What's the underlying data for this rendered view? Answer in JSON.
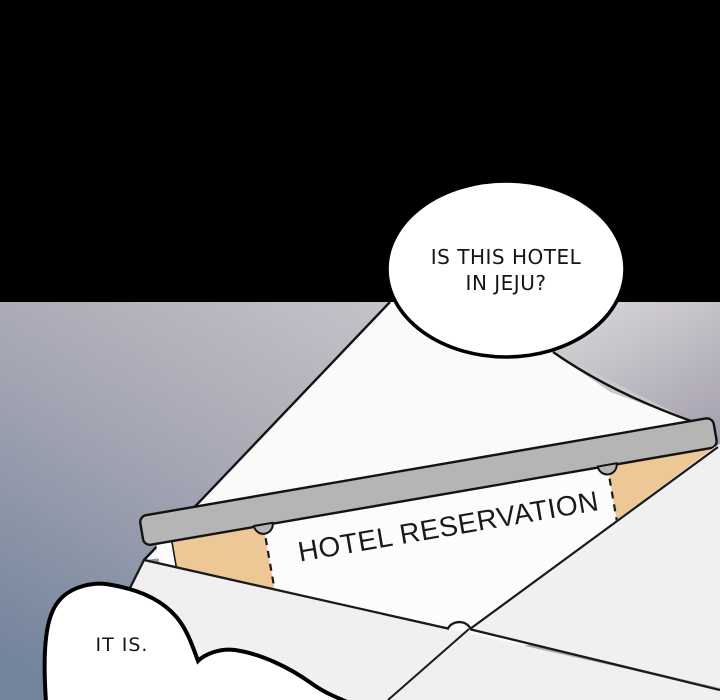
{
  "panel": {
    "alt": "Webtoon panel of an open envelope holding a hotel reservation ticket",
    "width": "720",
    "height": "700"
  },
  "bubbles": {
    "question": {
      "line1": "IS THIS HOTEL",
      "line2": "IN JEJU?"
    },
    "answer": {
      "text": "IT IS."
    }
  },
  "ticket": {
    "title": "HOTEL RESERVATION"
  },
  "colors": {
    "black_band": "#000000",
    "sky_top": "#e1dedd",
    "sky_bottom": "#73849c",
    "envelope_inside_top": "#d8d6d8",
    "envelope_inside_bottom": "#a49fae",
    "flap": "#fafafa",
    "front": "#f1f0f1",
    "band": "#b5b5b5",
    "paper": "#fcfcfc",
    "stub": "#edc795",
    "ink": "#131313",
    "bubble_fill": "#ffffff"
  }
}
